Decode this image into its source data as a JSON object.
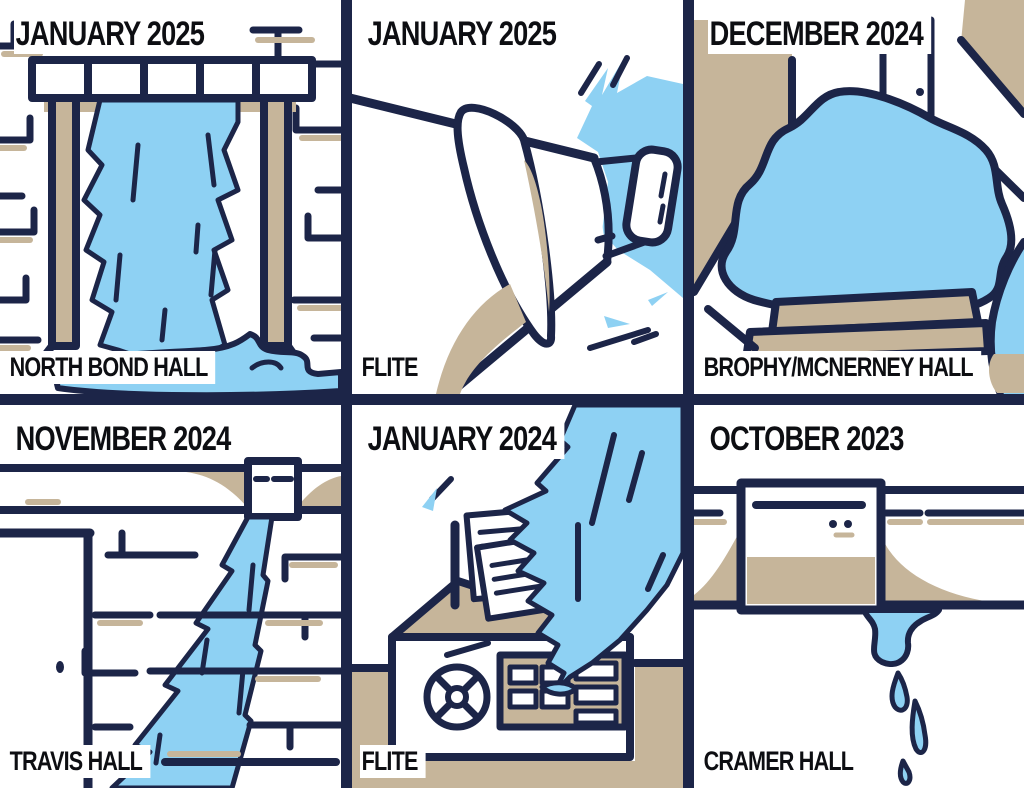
{
  "title": "Campus water leak incidents comic grid",
  "colors": {
    "outline_navy": "#1c2548",
    "water_blue": "#8ed1f3",
    "stain_tan": "#c6b59a",
    "label_ink": "#0d0e12",
    "panel_bg": "#ffffff"
  },
  "panels": [
    {
      "id": "north-bond-hall",
      "date": "JANUARY 2025",
      "location": "NORTH BOND HALL",
      "scene": "water-pouring-through-doorway"
    },
    {
      "id": "flite-january-2025",
      "date": "JANUARY 2025",
      "location": "FLITE",
      "scene": "burst-pipe-spraying-water"
    },
    {
      "id": "brophy-mcnerney",
      "date": "DECEMBER 2024",
      "location": "BROPHY/MCNERNEY HALL",
      "scene": "flooded-hallway-floor"
    },
    {
      "id": "travis-hall",
      "date": "NOVEMBER 2024",
      "location": "TRAVIS HALL",
      "scene": "water-streaming-down-brick-wall"
    },
    {
      "id": "flite-january-2024",
      "date": "JANUARY 2024",
      "location": "FLITE",
      "scene": "water-pouring-on-equipment"
    },
    {
      "id": "cramer-hall",
      "date": "OCTOBER 2023",
      "location": "CRAMER HALL",
      "scene": "ceiling-fixture-dripping"
    }
  ]
}
